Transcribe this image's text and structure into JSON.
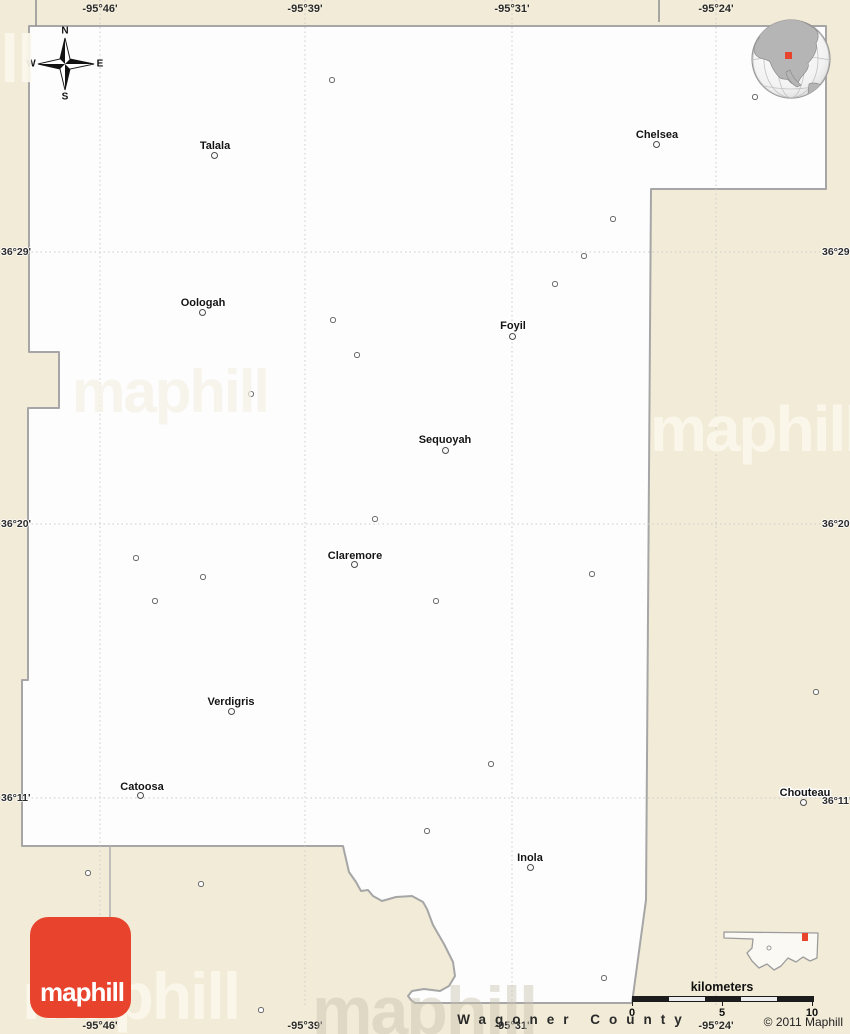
{
  "grid": {
    "top_longitude_labels": [
      {
        "text": "-95°46'",
        "x": 100
      },
      {
        "text": "-95°39'",
        "x": 305
      },
      {
        "text": "-95°31'",
        "x": 512
      },
      {
        "text": "-95°24'",
        "x": 716
      }
    ],
    "bottom_longitude_labels": [
      {
        "text": "-95°46'",
        "x": 100
      },
      {
        "text": "-95°39'",
        "x": 305
      },
      {
        "text": "-95°31'",
        "x": 512
      },
      {
        "text": "-95°24'",
        "x": 716
      }
    ],
    "left_latitude_labels": [
      {
        "text": "36°29'",
        "y": 252
      },
      {
        "text": "36°20'",
        "y": 524
      },
      {
        "text": "36°11'",
        "y": 798
      }
    ],
    "right_latitude_labels": [
      {
        "text": "36°29'",
        "y": 252
      },
      {
        "text": "36°20'",
        "y": 524
      },
      {
        "text": "36°11'",
        "y": 801
      }
    ]
  },
  "cities": [
    {
      "name": "Talala",
      "label_x": 215,
      "label_y": 146,
      "dot_x": 215,
      "dot_y": 156
    },
    {
      "name": "Chelsea",
      "label_x": 657,
      "label_y": 135,
      "dot_x": 657,
      "dot_y": 145
    },
    {
      "name": "Oologah",
      "label_x": 203,
      "label_y": 303,
      "dot_x": 203,
      "dot_y": 313
    },
    {
      "name": "Foyil",
      "label_x": 513,
      "label_y": 326,
      "dot_x": 513,
      "dot_y": 337
    },
    {
      "name": "Sequoyah",
      "label_x": 445,
      "label_y": 440,
      "dot_x": 446,
      "dot_y": 451
    },
    {
      "name": "Claremore",
      "label_x": 355,
      "label_y": 556,
      "dot_x": 355,
      "dot_y": 565
    },
    {
      "name": "Verdigris",
      "label_x": 231,
      "label_y": 702,
      "dot_x": 232,
      "dot_y": 712
    },
    {
      "name": "Catoosa",
      "label_x": 142,
      "label_y": 787,
      "dot_x": 141,
      "dot_y": 796
    },
    {
      "name": "Inola",
      "label_x": 530,
      "label_y": 858,
      "dot_x": 531,
      "dot_y": 868
    },
    {
      "name": "Chouteau",
      "label_x": 805,
      "label_y": 793,
      "dot_x": 804,
      "dot_y": 803
    }
  ],
  "settlement_dots": [
    [
      332,
      80
    ],
    [
      755,
      97
    ],
    [
      613,
      219
    ],
    [
      584,
      256
    ],
    [
      555,
      284
    ],
    [
      333,
      320
    ],
    [
      357,
      355
    ],
    [
      251,
      394
    ],
    [
      375,
      519
    ],
    [
      136,
      558
    ],
    [
      592,
      574
    ],
    [
      203,
      577
    ],
    [
      155,
      601
    ],
    [
      436,
      601
    ],
    [
      816,
      692
    ],
    [
      491,
      764
    ],
    [
      427,
      831
    ],
    [
      88,
      873
    ],
    [
      201,
      884
    ],
    [
      604,
      978
    ],
    [
      261,
      1010
    ]
  ],
  "compass": {
    "north": "N",
    "east": "E",
    "south": "S",
    "west": "W"
  },
  "scale_bar": {
    "unit_label": "kilometers",
    "tick_labels": [
      {
        "text": "0",
        "x": 632
      },
      {
        "text": "5",
        "x": 722
      },
      {
        "text": "10",
        "x": 812
      }
    ]
  },
  "footer": {
    "neighbor_county_label": "Wagoner County",
    "copyright": "© 2011 Maphill"
  },
  "logo": {
    "text": "maphill"
  },
  "watermark": {
    "text": "maphill"
  },
  "colors": {
    "background": "#f1ebd7",
    "county_fill": "#fdfdfd",
    "boundary_gray": "#a6a6a6",
    "logo_red": "#e8432d",
    "location_marker_red": "#e8432d"
  }
}
